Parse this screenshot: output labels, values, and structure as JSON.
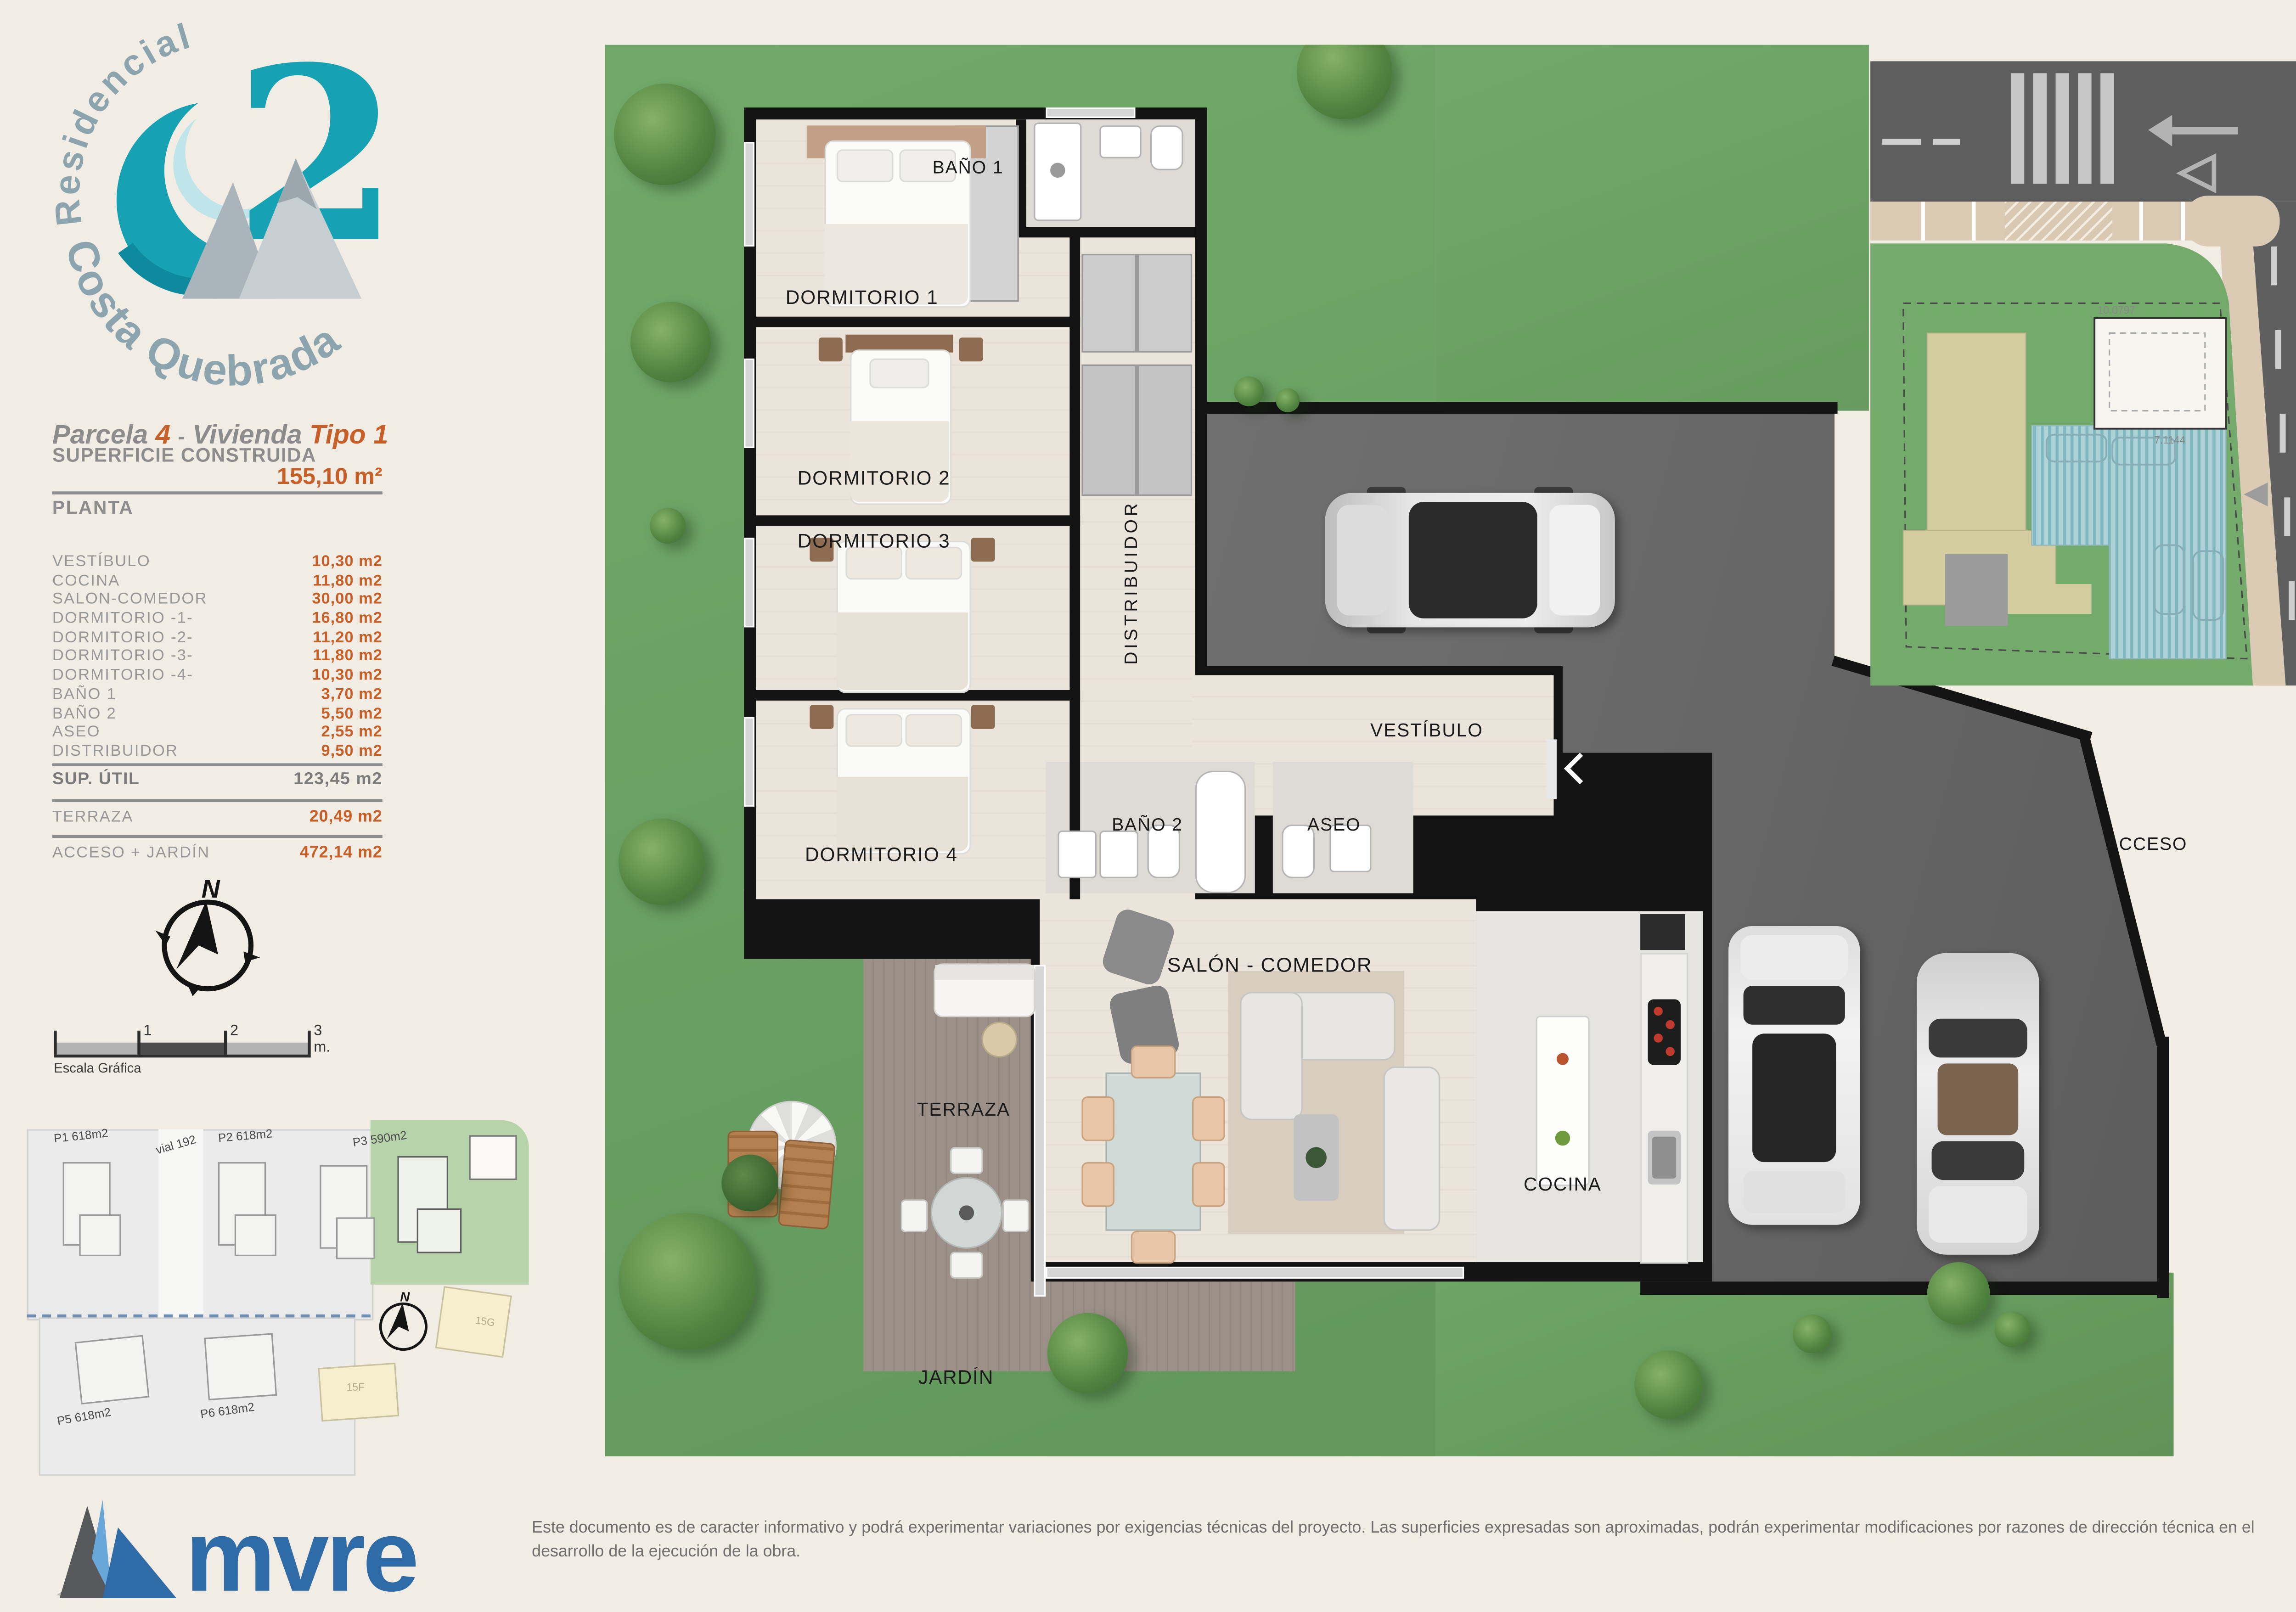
{
  "branding": {
    "residencial": "Residencial",
    "project_number": "2",
    "project_name": "Costa Quebrada",
    "agency": "mvre"
  },
  "header": {
    "parcela_label": "Parcela",
    "parcela_value": "4",
    "dash": "-",
    "vivienda_label": "Vivienda",
    "tipo_label": "Tipo",
    "tipo_value": "1"
  },
  "surface": {
    "title": "SUPERFICIE CONSTRUIDA",
    "value": "155,10 m²",
    "planta": "PLANTA"
  },
  "rooms": [
    {
      "label": "VESTÍBULO",
      "value": "10,30 m2"
    },
    {
      "label": "COCINA",
      "value": "11,80 m2"
    },
    {
      "label": "SALON-COMEDOR",
      "value": "30,00 m2"
    },
    {
      "label": "DORMITORIO -1-",
      "value": "16,80 m2"
    },
    {
      "label": "DORMITORIO -2-",
      "value": "11,20 m2"
    },
    {
      "label": "DORMITORIO -3-",
      "value": "11,80 m2"
    },
    {
      "label": "DORMITORIO -4-",
      "value": "10,30 m2"
    },
    {
      "label": "BAÑO 1",
      "value": "3,70 m2"
    },
    {
      "label": "BAÑO 2",
      "value": "5,50 m2"
    },
    {
      "label": "ASEO",
      "value": "2,55 m2"
    },
    {
      "label": "DISTRIBUIDOR",
      "value": "9,50 m2"
    }
  ],
  "totals": {
    "util_label": "SUP. ÚTIL",
    "util_value": "123,45 m2",
    "terraza_label": "TERRAZA",
    "terraza_value": "20,49 m2",
    "acceso_label": "ACCESO + JARDÍN",
    "acceso_value": "472,14 m2"
  },
  "compass": {
    "north": "N"
  },
  "scalebar": {
    "t1": "1",
    "t2": "2",
    "t3": "3 m.",
    "caption": "Escala Gráfica"
  },
  "siteplan": {
    "p1": "P1 618m2",
    "vial": "vial 192",
    "p2": "P2 618m2",
    "p3": "P3 590m2",
    "p5": "P5 618m2",
    "p6": "P6 618m2",
    "b15f": "15F",
    "b15g": "15G"
  },
  "plan": {
    "dorm1": "DORMITORIO 1",
    "bano1": "BAÑO 1",
    "dorm2": "DORMITORIO 2",
    "dorm3": "DORMITORIO 3",
    "distribuidor": "DISTRIBUIDOR",
    "vestibulo": "VESTÍBULO",
    "bano2": "BAÑO 2",
    "aseo": "ASEO",
    "dorm4": "DORMITORIO 4",
    "salon": "SALÓN - COMEDOR",
    "terraza": "TERRAZA",
    "cocina": "COCINA",
    "jardin": "JARDÍN",
    "acceso": "ACCESO"
  },
  "inset": {
    "dim_top": "10.0797",
    "dim_bottom": "7.1144"
  },
  "footer": {
    "disclaimer": "Este documento es de caracter informativo y podrá experimentar variaciones por exigencias técnicas del proyecto. Las superficies expresadas son aproximadas, podrán experimentar modificaciones por razones de dirección técnica en el desarrollo de la ejecución de la obra."
  },
  "colors": {
    "accent_orange": "#c75f28",
    "brand_teal": "#17a2b4",
    "brand_gray_blue": "#8ca4ae",
    "mvre_blue": "#2f6ba6",
    "grass": "#6ba263",
    "asphalt": "#6b6b6b"
  }
}
